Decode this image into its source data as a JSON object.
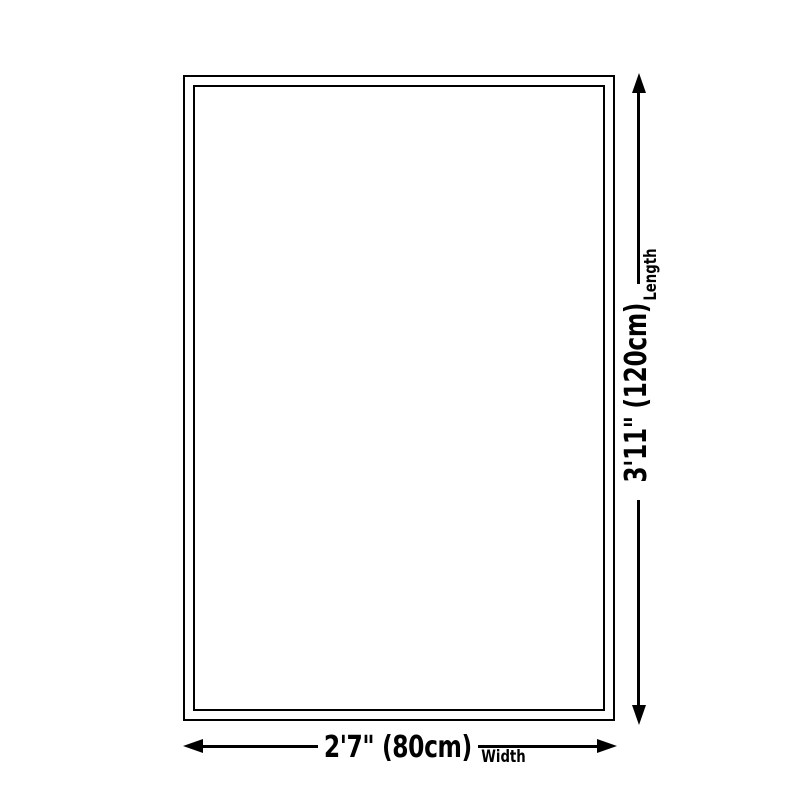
{
  "diagram": {
    "length": {
      "dimension": "3'11\" (120cm)",
      "axis": "Length"
    },
    "width": {
      "dimension": "2'7\" (80cm)",
      "axis": "Width"
    },
    "colors": {
      "line": "#000000",
      "background": "#ffffff"
    }
  }
}
